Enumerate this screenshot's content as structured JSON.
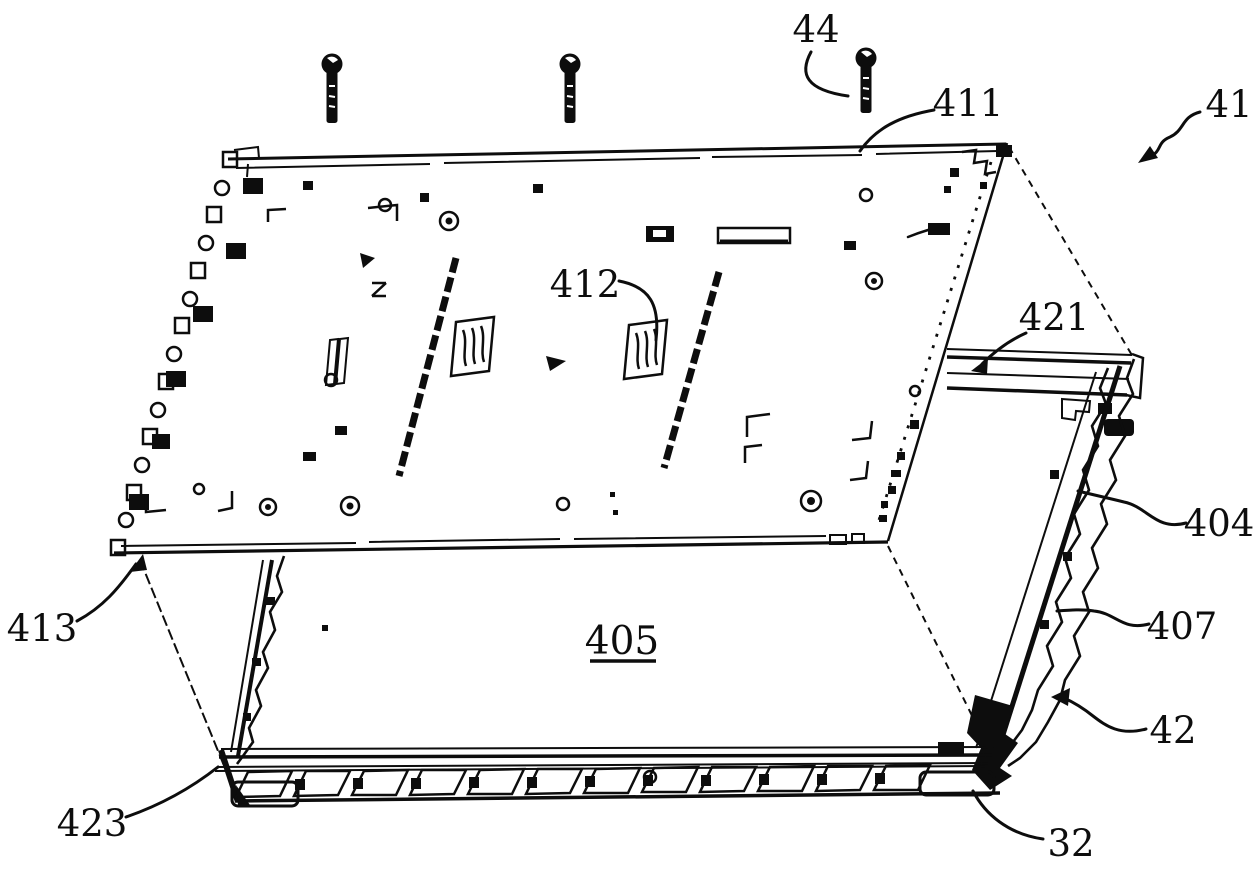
{
  "figure": {
    "background": "#ffffff",
    "ink_color": "#0d0d0d",
    "reference_labels": {
      "44": "44",
      "411": "411",
      "41": "41",
      "412": "412",
      "421": "421",
      "404": "404",
      "407": "407",
      "413": "413",
      "405": "405",
      "42": "42",
      "423": "423",
      "32": "32"
    }
  }
}
